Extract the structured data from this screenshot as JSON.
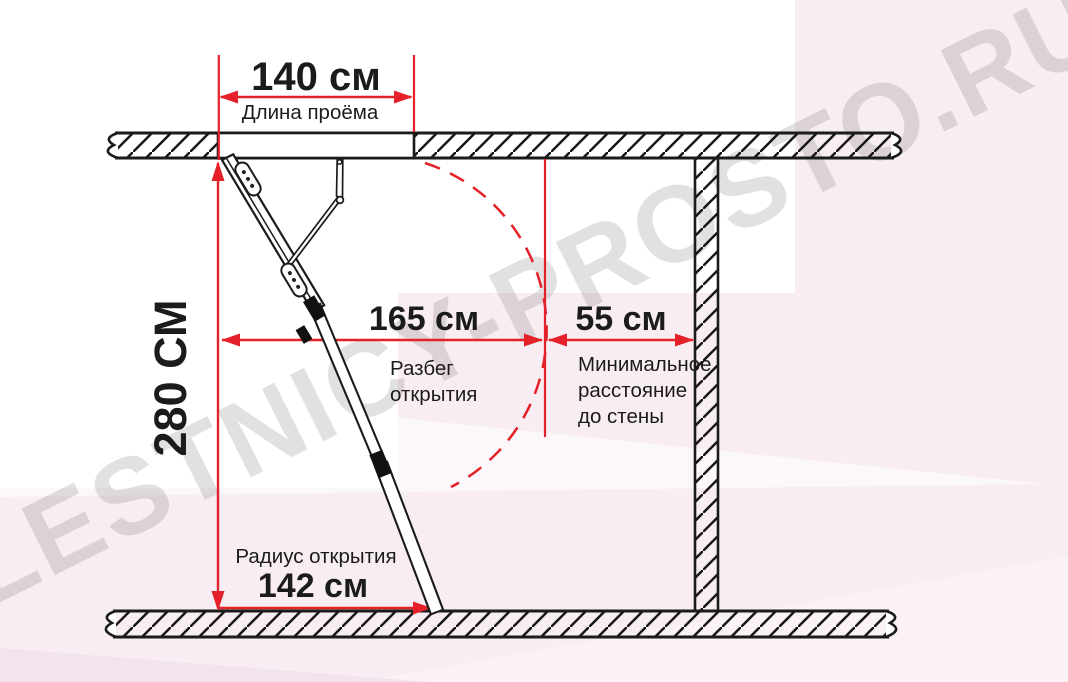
{
  "watermark": "LESTNICY-PROSTO.RU",
  "colors": {
    "accent_red": "#e42028",
    "line_black": "#1b1b1b",
    "bg_pink": "#f8edf3",
    "watermark_gray": "#dedede"
  },
  "dimensions": {
    "opening_length": {
      "value": "140 см",
      "label": "Длина проёма"
    },
    "ceiling_height": {
      "value": "280 СМ"
    },
    "opening_span": {
      "value": "165 см",
      "label_lines": [
        "Разбег",
        "открытия"
      ]
    },
    "wall_distance": {
      "value": "55 см",
      "label_lines": [
        "Минимальное",
        "расстояние",
        "до стены"
      ]
    },
    "opening_radius": {
      "value": "142 см",
      "label": "Радиус открытия"
    }
  }
}
